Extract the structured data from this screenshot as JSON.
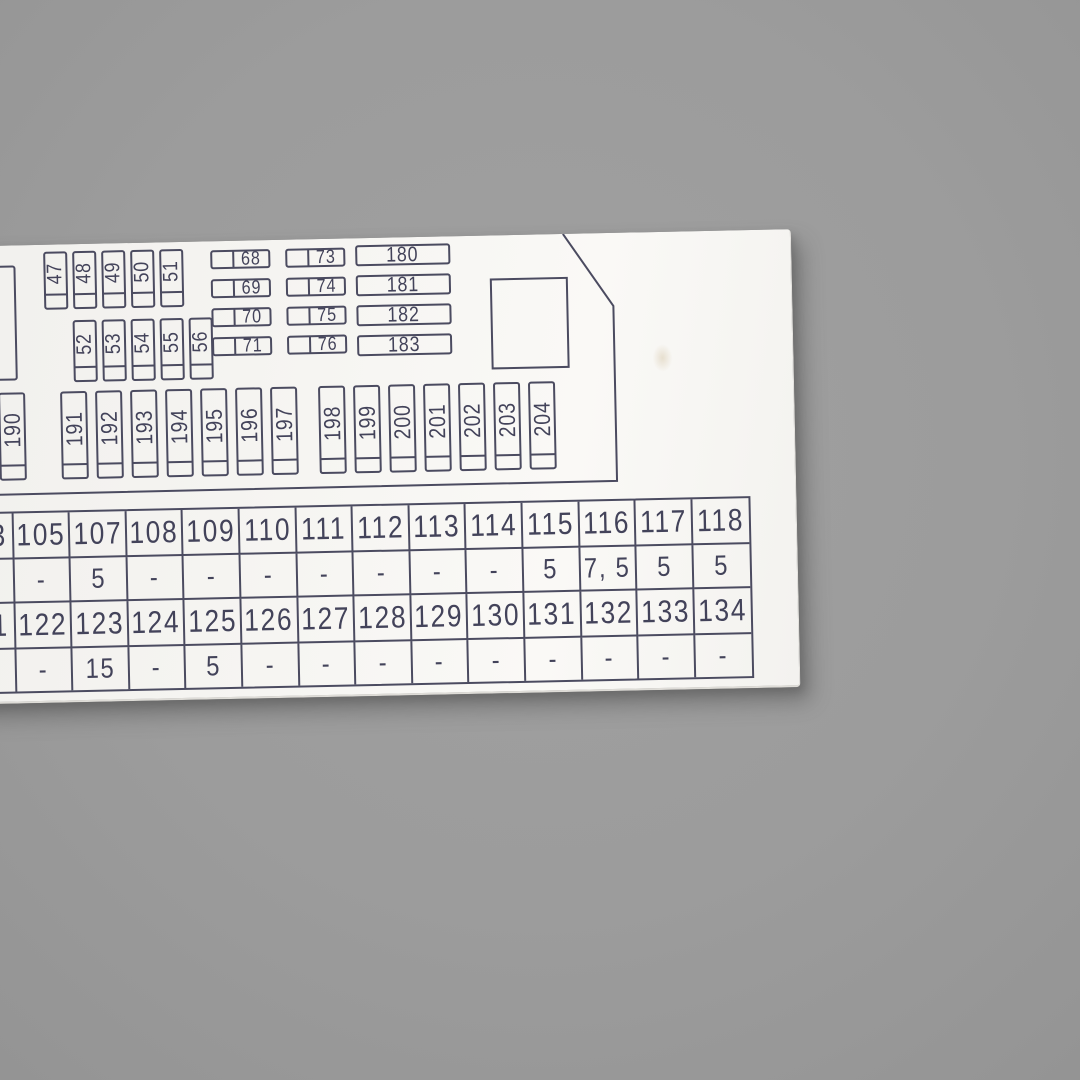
{
  "photo": {
    "background_color": "#9c9c9c",
    "card_color": "#f5f4f1",
    "line_color": "#4b4b60",
    "text_color": "#43435a"
  },
  "fuses": {
    "vertical_row1": {
      "labels": [
        "47",
        "48",
        "49",
        "50",
        "51"
      ]
    },
    "vertical_row2": {
      "labels": [
        "52",
        "53",
        "54",
        "55",
        "56"
      ]
    },
    "horizontal_col1": {
      "labels": [
        "68",
        "69",
        "70",
        "71"
      ]
    },
    "horizontal_col2": {
      "labels": [
        "73",
        "74",
        "75",
        "76"
      ]
    },
    "wide_column": {
      "labels": [
        "180",
        "181",
        "182",
        "183"
      ]
    },
    "bottom_row": {
      "groups": [
        [
          "190"
        ],
        [
          "191",
          "192",
          "193",
          "194",
          "195",
          "196",
          "197"
        ],
        [
          "198",
          "199",
          "200",
          "201",
          "202",
          "203",
          "204"
        ]
      ]
    }
  },
  "amperage_table": {
    "rows": [
      {
        "kind": "fuse-numbers",
        "cells": [
          "3",
          "105",
          "107",
          "108",
          "109",
          "110",
          "111",
          "112",
          "113",
          "114",
          "115",
          "116",
          "117",
          "118"
        ]
      },
      {
        "kind": "amperage",
        "cells": [
          "",
          "-",
          "5",
          "-",
          "-",
          "-",
          "-",
          "-",
          "-",
          "-",
          "5",
          "7, 5",
          "5",
          "5"
        ]
      },
      {
        "kind": "fuse-numbers",
        "cells": [
          "1",
          "122",
          "123",
          "124",
          "125",
          "126",
          "127",
          "128",
          "129",
          "130",
          "131",
          "132",
          "133",
          "134"
        ]
      },
      {
        "kind": "amperage",
        "cells": [
          "",
          "-",
          "15",
          "-",
          "5",
          "-",
          "-",
          "-",
          "-",
          "-",
          "-",
          "-",
          "-",
          "-"
        ]
      }
    ]
  }
}
